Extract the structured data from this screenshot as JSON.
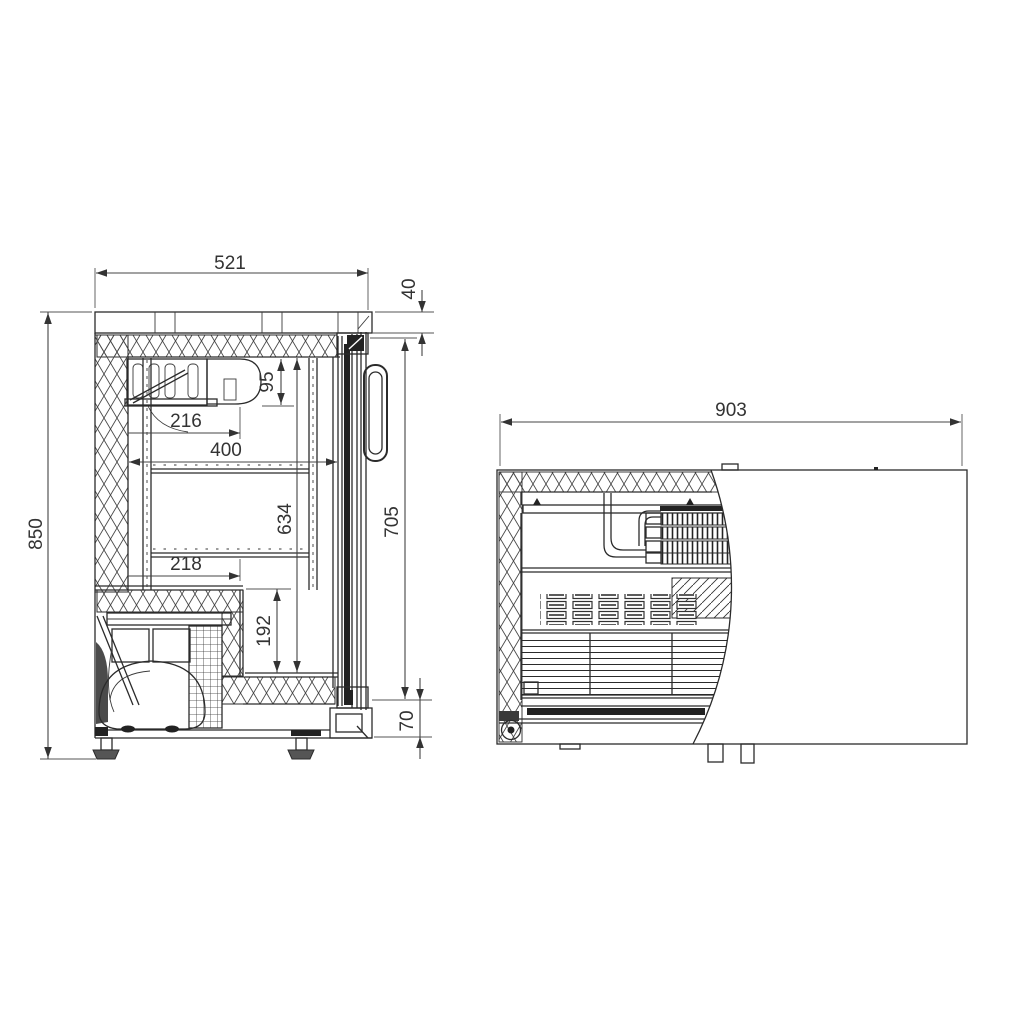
{
  "drawing": {
    "background": "#ffffff",
    "line_color": "#2b2b2b",
    "dimension_color": "#333333",
    "dimensions": {
      "side_view": {
        "overall_height": "850",
        "worktop_width": "521",
        "worktop_thickness": "40",
        "evaporator_depth": "95",
        "shelf_inset_upper": "216",
        "interior_depth": "400",
        "interior_height": "634",
        "shelf_inset_lower": "218",
        "base_step_height": "192",
        "door_height": "705",
        "plinth_height": "70"
      },
      "plan_view": {
        "overall_width": "903"
      }
    }
  }
}
